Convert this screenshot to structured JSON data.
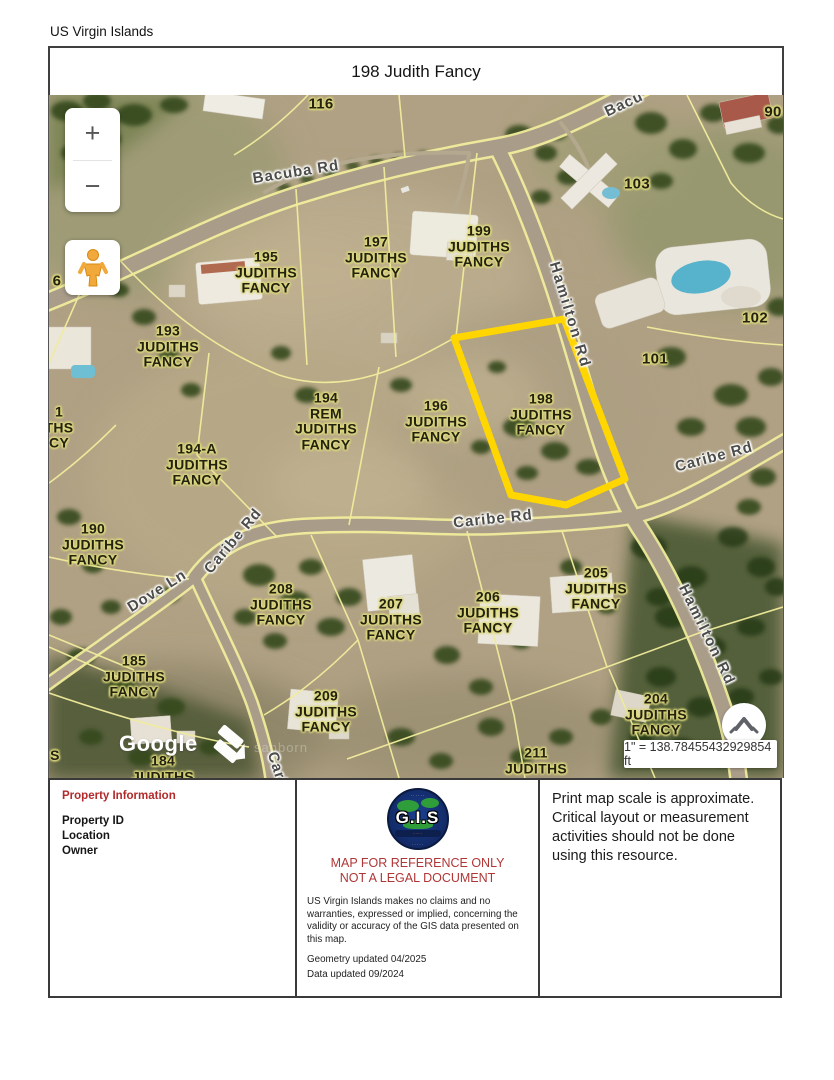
{
  "page": {
    "region": "US Virgin Islands",
    "title": "198 Judith Fancy"
  },
  "map": {
    "controls": {
      "zoom_in": "+",
      "zoom_out": "−",
      "scale_text": "1\" = 138.78455432929854 ft"
    },
    "attribution": {
      "google": "Google",
      "sanborn": "sanborn"
    },
    "highlight_color": "#FFD600",
    "parcel_line_color": "#F1EC9C",
    "labels": {
      "p116": "116",
      "p90": "90",
      "p103": "103",
      "p195": "195\nJUDITHS\nFANCY",
      "p197": "197\nJUDITHS\nFANCY",
      "p199": "199\nJUDITHS\nFANCY",
      "p102": "102",
      "p101": "101",
      "p193": "193\nJUDITHS\nFANCY",
      "p194": "194\nREM\nJUDITHS\nFANCY",
      "p196": "196\nJUDITHS\nFANCY",
      "p198": "198\nJUDITHS\nFANCY",
      "p194a": "194-A\nJUDITHS\nFANCY",
      "p190": "190\nJUDITHS\nFANCY",
      "p208": "208\nJUDITHS\nFANCY",
      "p207": "207\nJUDITHS\nFANCY",
      "p206": "206\nJUDITHS\nFANCY",
      "p205": "205\nJUDITHS\nFANCY",
      "p185": "185\nJUDITHS\nFANCY",
      "p209": "209\nJUDITHS\nFANCY",
      "p204": "204\nJUDITHS\nFANCY",
      "p211": "211\nJUDITHS",
      "p184": "184\nJUDITHS",
      "frag6": "6",
      "frag191": "1\nTHS\nCY",
      "fragS": "S"
    },
    "roads": {
      "bacuba": "Bacuba Rd",
      "bacuba_ne": "Bacu",
      "hamilton_n": "Hamilton Rd",
      "hamilton_s": "Hamilton Rd",
      "caribe_mid": "Caribe Rd",
      "caribe_e": "Caribe Rd",
      "caribe_w": "Caribe Rd",
      "dove": "Dove Ln",
      "caribe_ln": "Cari"
    }
  },
  "footer": {
    "property_information": {
      "heading": "Property Information",
      "fields": [
        "Property ID",
        "Location",
        "Owner"
      ]
    },
    "center": {
      "logo_text": "G.I.S",
      "reference_line1": "MAP FOR REFERENCE ONLY",
      "reference_line2": "NOT A LEGAL DOCUMENT",
      "disclaimer": "US Virgin Islands makes no claims and no warranties, expressed or implied, concerning the validity or accuracy of the GIS data presented on this map.",
      "geometry_updated": "Geometry updated 04/2025",
      "data_updated": "Data updated 09/2024"
    },
    "right_note": "Print map scale is approximate. Critical layout or measurement activities should not be done using this resource."
  }
}
